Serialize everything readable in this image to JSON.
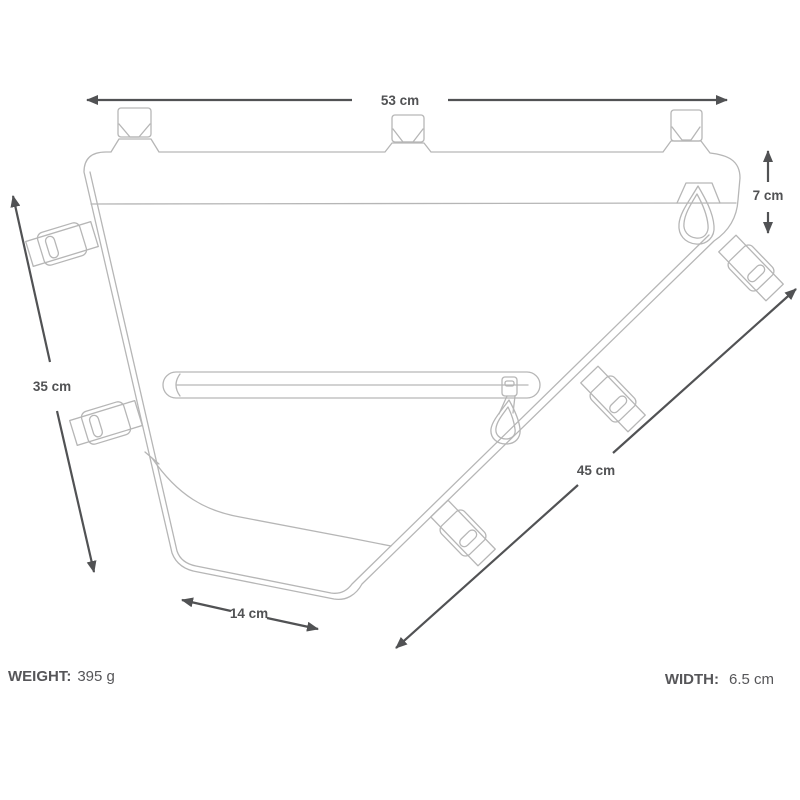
{
  "colors": {
    "background": "#ffffff",
    "artwork_line": "#b6b6b6",
    "dimension": "#515254",
    "text": "#565659"
  },
  "diagram": {
    "title": "bicycle frame bag dimension line drawing",
    "dimensions": {
      "top": "53 cm",
      "left": "35 cm",
      "diagonal": "45 cm",
      "bottom": "14 cm",
      "depth": "7 cm"
    }
  },
  "specs": {
    "weight_label": "WEIGHT:",
    "weight_value": "395 g",
    "width_label": "WIDTH:",
    "width_value": "6.5 cm"
  }
}
